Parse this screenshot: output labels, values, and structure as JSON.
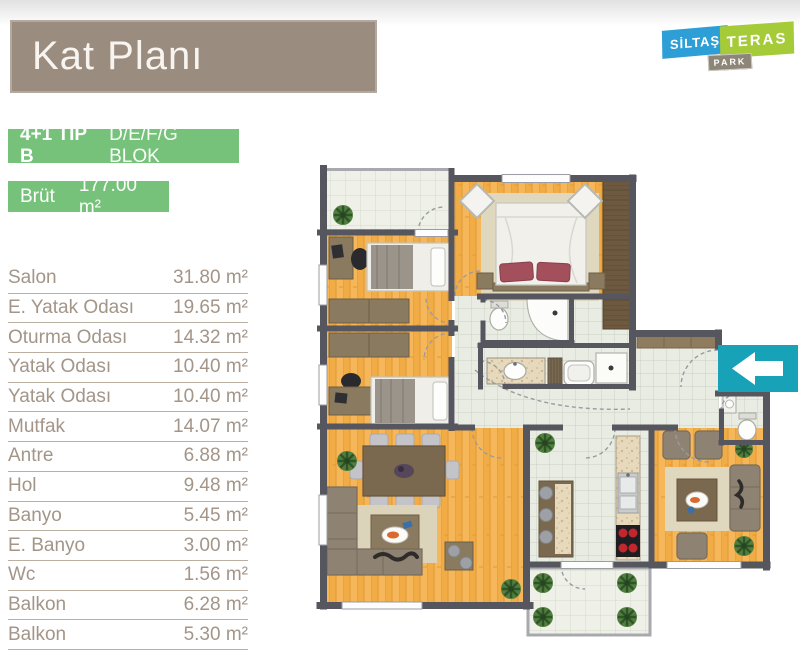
{
  "header": {
    "title": "Kat Planı",
    "bg_color": "#9A8C7E"
  },
  "logo": {
    "siltas": "SİLTAŞ",
    "teras": "TERAS",
    "park": "PARK",
    "blue": "#2E9ED6",
    "green": "#A6CB39",
    "gray": "#8D8578"
  },
  "unit_info": {
    "type": "4+1 TİP B",
    "block": "D/E/F/G BLOK",
    "gross_label": "Brüt",
    "gross_area": "177.00 m²",
    "badge_color": "#77C27B"
  },
  "rooms": [
    {
      "name": "Salon",
      "area": "31.80 m²"
    },
    {
      "name": "E. Yatak Odası",
      "area": "19.65 m²"
    },
    {
      "name": "Oturma Odası",
      "area": "14.32 m²"
    },
    {
      "name": "Yatak Odası",
      "area": "10.40 m²"
    },
    {
      "name": "Yatak Odası",
      "area": "10.40 m²"
    },
    {
      "name": "Mutfak",
      "area": "14.07 m²"
    },
    {
      "name": "Antre",
      "area": "6.88 m²"
    },
    {
      "name": "Hol",
      "area": "9.48 m²"
    },
    {
      "name": "Banyo",
      "area": "5.45 m²"
    },
    {
      "name": "E. Banyo",
      "area": "3.00 m²"
    },
    {
      "name": "Wc",
      "area": "1.56 m²"
    },
    {
      "name": "Balkon",
      "area": "6.28 m²"
    },
    {
      "name": "Balkon",
      "area": "5.30 m²"
    }
  ],
  "floor_plan": {
    "entrance_color": "#17A2B8",
    "wall_color": "#56565E",
    "wood_color": "#F2AC45",
    "tile_color": "#E9ECE3"
  }
}
